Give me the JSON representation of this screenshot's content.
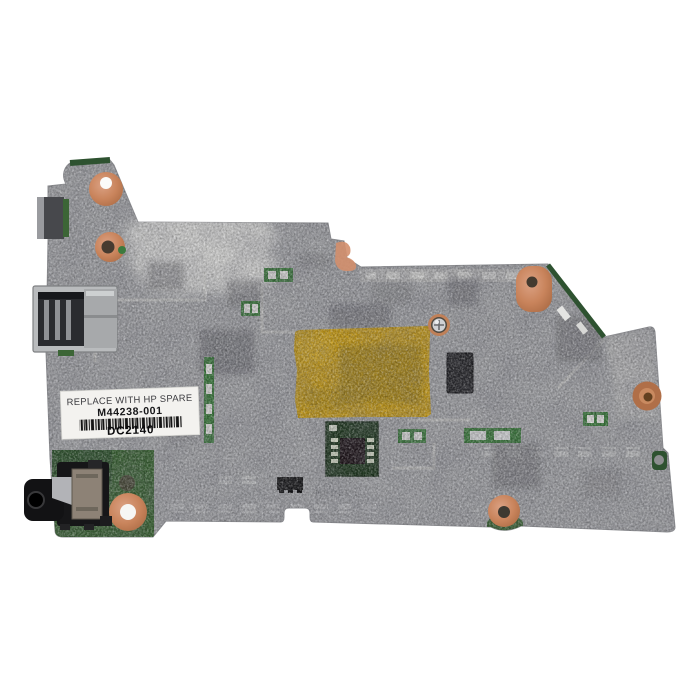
{
  "photo": {
    "description": "Top-down product photo of a laptop motherboard spare part on a white background"
  },
  "product_label": {
    "line1": "REPLACE WITH HP SPARE",
    "part_number": "M44238-001",
    "date_code": "DC2140"
  },
  "board_silkscreen": {
    "model_text": "MODEL:"
  },
  "colors": {
    "background": "#ffffff",
    "board_film": "#a4a5a9",
    "board_edge": "#8e8f93",
    "pcb_green": "#3c6536",
    "pcb_green_dark": "#2e5230",
    "copper_pad": "#c9845c",
    "kapton_tape": "#c79d1d",
    "label_bg": "#f3f2ef",
    "usb_metal": "#b9bbbd",
    "jack_black": "#161618",
    "chip_black": "#26262a",
    "light_patch": "#dddddb"
  }
}
